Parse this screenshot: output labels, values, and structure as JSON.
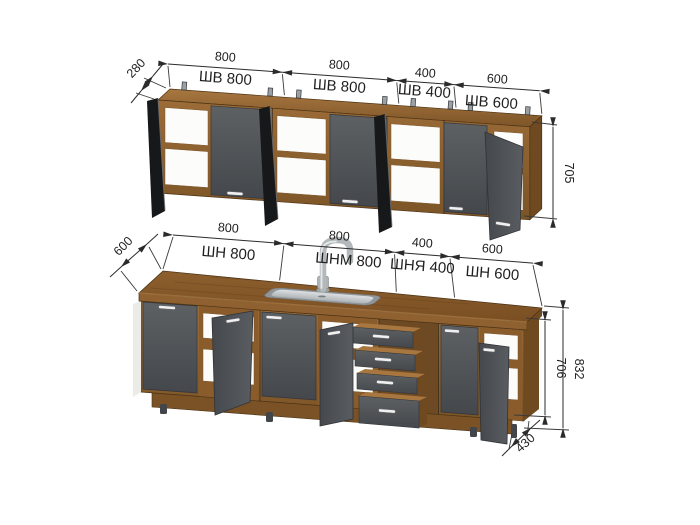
{
  "upper_row": {
    "depth_dim": "280",
    "height_dim": "705",
    "segments": [
      {
        "width_dim": "800",
        "label": "ШВ 800"
      },
      {
        "width_dim": "800",
        "label": "ШВ 800"
      },
      {
        "width_dim": "400",
        "label": "ШВ 400"
      },
      {
        "width_dim": "600",
        "label": "ШВ 600"
      }
    ]
  },
  "lower_row": {
    "depth_dim": "600",
    "cabinet_height_dim": "706",
    "total_height_dim": "832",
    "base_depth_dim": "430",
    "segments": [
      {
        "width_dim": "800",
        "label": "ШН 800"
      },
      {
        "width_dim": "800",
        "label": "ШНМ 800"
      },
      {
        "width_dim": "400",
        "label": "ШНЯ 400"
      },
      {
        "width_dim": "600",
        "label": "ШН 600"
      }
    ]
  },
  "colors": {
    "wood": "#96683a",
    "facade_gray": "#53565a",
    "dimension_text": "#1f1f1f",
    "background": "#ffffff"
  }
}
